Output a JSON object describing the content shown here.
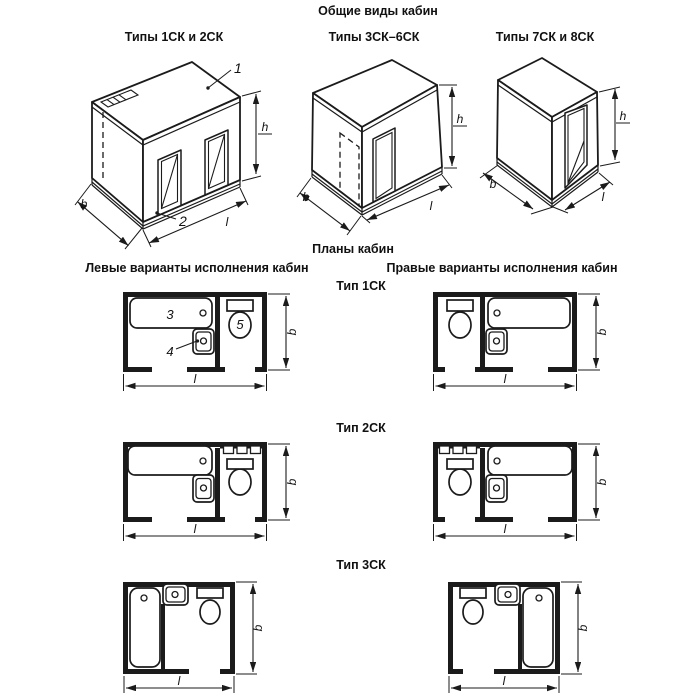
{
  "title": "Общие виды кабин",
  "plans_title": "Планы кабин",
  "variants": {
    "left": "Левые варианты исполнения кабин",
    "right": "Правые варианты исполнения кабин"
  },
  "iso": [
    {
      "label": "Типы 1СК и 2СК",
      "callout_roof": "1",
      "callout_base": "2",
      "dim_b": "b",
      "dim_l": "l",
      "dim_h": "h"
    },
    {
      "label": "Типы 3СК–6СК",
      "dim_b": "b",
      "dim_l": "l",
      "dim_h": "h"
    },
    {
      "label": "Типы 7СК и 8СК",
      "dim_b": "b",
      "dim_l": "l",
      "dim_h": "h"
    }
  ],
  "plan_rows": [
    {
      "label": "Тип 1СК",
      "callout_bath": "3",
      "callout_sink": "4",
      "callout_toilet": "5",
      "dim_b": "b",
      "dim_l": "l"
    },
    {
      "label": "Тип 2СК",
      "dim_b": "b",
      "dim_l": "l"
    },
    {
      "label": "Тип 3СК",
      "dim_b": "b",
      "dim_l": "l"
    }
  ],
  "colors": {
    "line": "#1b1b1b",
    "background": "#ffffff"
  }
}
